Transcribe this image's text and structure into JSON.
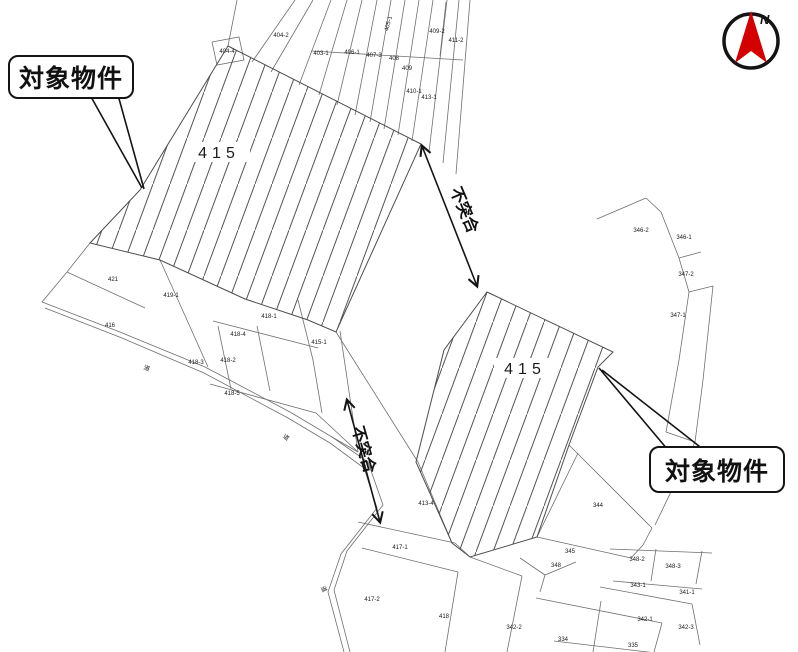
{
  "callouts": [
    {
      "label": "対象物件"
    },
    {
      "label": "対象物件"
    }
  ],
  "mismatch": [
    {
      "label": "不突合"
    },
    {
      "label": "不突合"
    }
  ],
  "highlight_parcels": [
    {
      "number": "415"
    },
    {
      "number": "415"
    }
  ],
  "compass": {
    "north_label": "N",
    "arrow_color": "#d40000"
  },
  "colors": {
    "background": "#ffffff",
    "map_line": "#6f6f6f",
    "hatch_line": "#565656",
    "annotation": "#141414",
    "compass_arrow": "#d40000"
  },
  "map": {
    "parcel_labels": [
      {
        "text": "404-4",
        "x": 227,
        "y": 53
      },
      {
        "text": "404-2",
        "x": 281,
        "y": 37
      },
      {
        "text": "403-1",
        "x": 321,
        "y": 55
      },
      {
        "text": "406-1",
        "x": 352,
        "y": 54
      },
      {
        "text": "407-3",
        "x": 374,
        "y": 57
      },
      {
        "text": "408",
        "x": 394,
        "y": 60
      },
      {
        "text": "409",
        "x": 407,
        "y": 70
      },
      {
        "text": "405-1",
        "x": 390,
        "y": 24,
        "rot": -75
      },
      {
        "text": "409-2",
        "x": 437,
        "y": 33
      },
      {
        "text": "411-2",
        "x": 456,
        "y": 42
      },
      {
        "text": "410-1",
        "x": 414,
        "y": 93
      },
      {
        "text": "413-1",
        "x": 429,
        "y": 99
      },
      {
        "text": "421",
        "x": 113,
        "y": 281
      },
      {
        "text": "419-1",
        "x": 171,
        "y": 297
      },
      {
        "text": "416",
        "x": 110,
        "y": 327
      },
      {
        "text": "418-3",
        "x": 196,
        "y": 364
      },
      {
        "text": "418-1",
        "x": 269,
        "y": 318
      },
      {
        "text": "418-4",
        "x": 238,
        "y": 336
      },
      {
        "text": "415-1",
        "x": 319,
        "y": 344
      },
      {
        "text": "418-2",
        "x": 228,
        "y": 362
      },
      {
        "text": "418-5",
        "x": 232,
        "y": 395
      },
      {
        "text": "道",
        "x": 146,
        "y": 370,
        "rot": 22
      },
      {
        "text": "道",
        "x": 285,
        "y": 439,
        "rot": 35
      },
      {
        "text": "道",
        "x": 322,
        "y": 590,
        "rot": 65
      },
      {
        "text": "413-4",
        "x": 426,
        "y": 505
      },
      {
        "text": "417-1",
        "x": 400,
        "y": 549
      },
      {
        "text": "417-2",
        "x": 372,
        "y": 601
      },
      {
        "text": "418",
        "x": 444,
        "y": 618
      },
      {
        "text": "342-2",
        "x": 514,
        "y": 629
      },
      {
        "text": "334",
        "x": 563,
        "y": 641
      },
      {
        "text": "335",
        "x": 633,
        "y": 647
      },
      {
        "text": "346-2",
        "x": 641,
        "y": 232
      },
      {
        "text": "346-1",
        "x": 684,
        "y": 239
      },
      {
        "text": "347-2",
        "x": 686,
        "y": 276
      },
      {
        "text": "347-1",
        "x": 678,
        "y": 317
      },
      {
        "text": "344",
        "x": 598,
        "y": 507
      },
      {
        "text": "345",
        "x": 570,
        "y": 553
      },
      {
        "text": "348",
        "x": 556,
        "y": 567
      },
      {
        "text": "348-2",
        "x": 637,
        "y": 561
      },
      {
        "text": "348-3",
        "x": 673,
        "y": 568
      },
      {
        "text": "343-1",
        "x": 638,
        "y": 587
      },
      {
        "text": "341-1",
        "x": 687,
        "y": 594
      },
      {
        "text": "342-1",
        "x": 645,
        "y": 621
      },
      {
        "text": "342-3",
        "x": 686,
        "y": 629
      }
    ]
  }
}
